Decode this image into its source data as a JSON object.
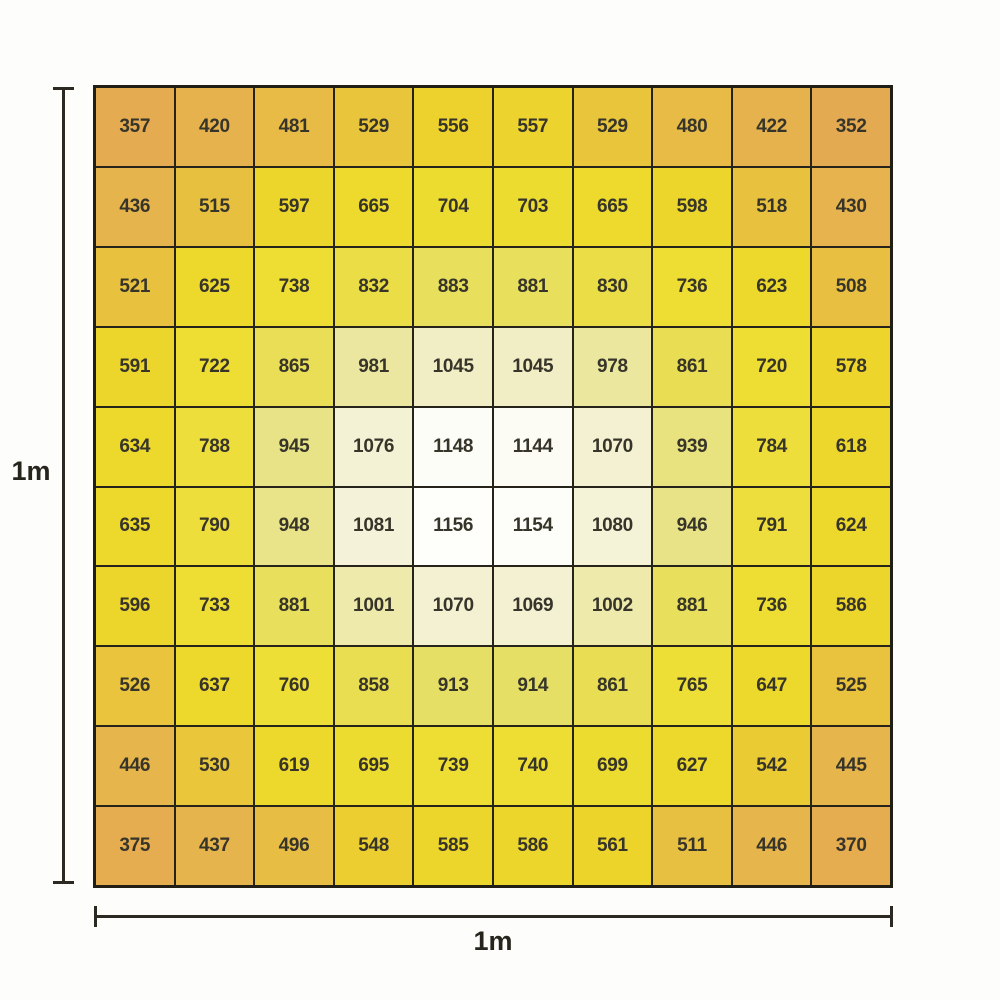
{
  "figure": {
    "left_dimension_label": "1m",
    "bottom_dimension_label": "1m"
  },
  "chart_data": {
    "type": "heatmap",
    "rows": 10,
    "cols": 10,
    "x_extent_label": "1m",
    "y_extent_label": "1m",
    "values": [
      [
        357,
        420,
        481,
        529,
        556,
        557,
        529,
        480,
        422,
        352
      ],
      [
        436,
        515,
        597,
        665,
        704,
        703,
        665,
        598,
        518,
        430
      ],
      [
        521,
        625,
        738,
        832,
        883,
        881,
        830,
        736,
        623,
        508
      ],
      [
        591,
        722,
        865,
        981,
        1045,
        1045,
        978,
        861,
        720,
        578
      ],
      [
        634,
        788,
        945,
        1076,
        1148,
        1144,
        1070,
        939,
        784,
        618
      ],
      [
        635,
        790,
        948,
        1081,
        1156,
        1154,
        1080,
        946,
        791,
        624
      ],
      [
        596,
        733,
        881,
        1001,
        1070,
        1069,
        1002,
        881,
        736,
        586
      ],
      [
        526,
        637,
        760,
        858,
        913,
        914,
        861,
        765,
        647,
        525
      ],
      [
        446,
        530,
        619,
        695,
        739,
        740,
        699,
        627,
        542,
        445
      ],
      [
        375,
        437,
        496,
        548,
        585,
        586,
        561,
        511,
        446,
        370
      ]
    ],
    "value_min": 352,
    "value_max": 1156,
    "color_scale": {
      "stops": [
        {
          "value": 350,
          "color": "#e4aa51"
        },
        {
          "value": 430,
          "color": "#e6b34e"
        },
        {
          "value": 520,
          "color": "#e8c13f"
        },
        {
          "value": 560,
          "color": "#edd42b"
        },
        {
          "value": 660,
          "color": "#edda2c"
        },
        {
          "value": 760,
          "color": "#eedf36"
        },
        {
          "value": 830,
          "color": "#ebdd45"
        },
        {
          "value": 880,
          "color": "#e8df5c"
        },
        {
          "value": 915,
          "color": "#e5df66"
        },
        {
          "value": 950,
          "color": "#e9e48b"
        },
        {
          "value": 980,
          "color": "#ebe79f"
        },
        {
          "value": 1005,
          "color": "#eeeaad"
        },
        {
          "value": 1045,
          "color": "#f1eec6"
        },
        {
          "value": 1080,
          "color": "#f4f2d7"
        },
        {
          "value": 1110,
          "color": "#f9f8e9"
        },
        {
          "value": 1160,
          "color": "#fefefb"
        }
      ]
    },
    "grid_line_color": "#26231a",
    "cell_text_color": "#37352a",
    "dimension_line_color": "#2b2922"
  }
}
